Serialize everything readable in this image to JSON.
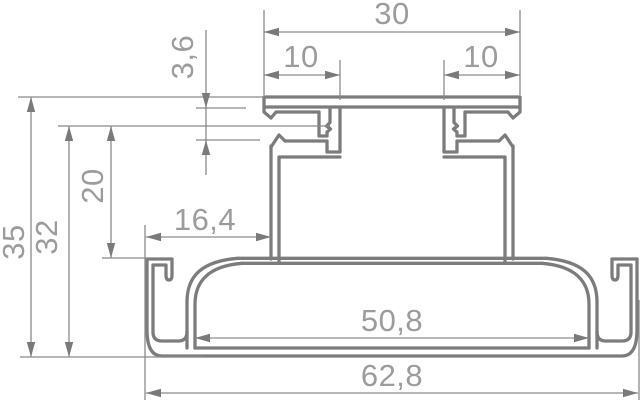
{
  "drawing": {
    "title": "extruded rail profile cross-section",
    "colors": {
      "background": "#ffffff",
      "profile_line": "#7c7c7c",
      "dimension_line": "#8a8a8a",
      "label_text": "#9c9c9c"
    }
  },
  "dims": {
    "top_width": "30",
    "top_slot_left": "10",
    "top_slot_right": "10",
    "lip_height": "3,6",
    "total_height": "35",
    "body_height": "32",
    "upper_height": "20",
    "side_offset": "16,4",
    "channel_span": "50,8",
    "total_width": "62,8"
  }
}
